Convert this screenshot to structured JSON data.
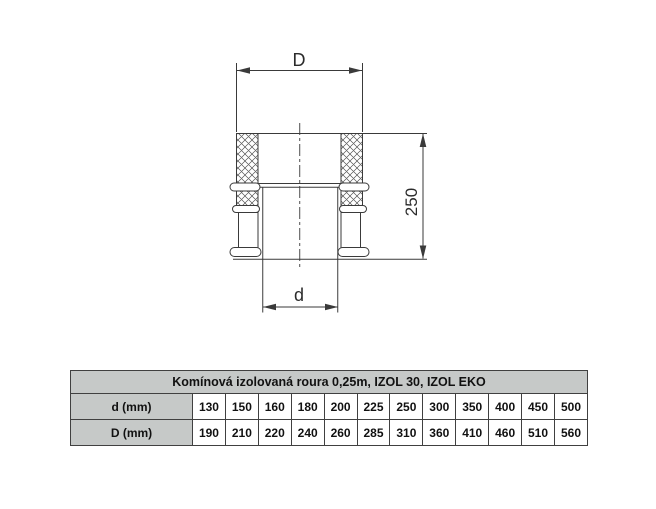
{
  "drawing": {
    "dim_outer_label": "D",
    "dim_inner_label": "d",
    "dim_height_label": "250"
  },
  "table": {
    "title": "Komínová izolovaná roura 0,25m, IZOL 30, IZOL EKO",
    "rows": [
      {
        "label": "d (mm)",
        "values": [
          "130",
          "150",
          "160",
          "180",
          "200",
          "225",
          "250",
          "300",
          "350",
          "400",
          "450",
          "500"
        ]
      },
      {
        "label": "D (mm)",
        "values": [
          "190",
          "210",
          "220",
          "240",
          "260",
          "285",
          "310",
          "360",
          "410",
          "460",
          "510",
          "560"
        ]
      }
    ]
  },
  "colors": {
    "line": "#3a3a3a",
    "table_header_bg": "#c6c9c8",
    "table_border": "#404040"
  }
}
